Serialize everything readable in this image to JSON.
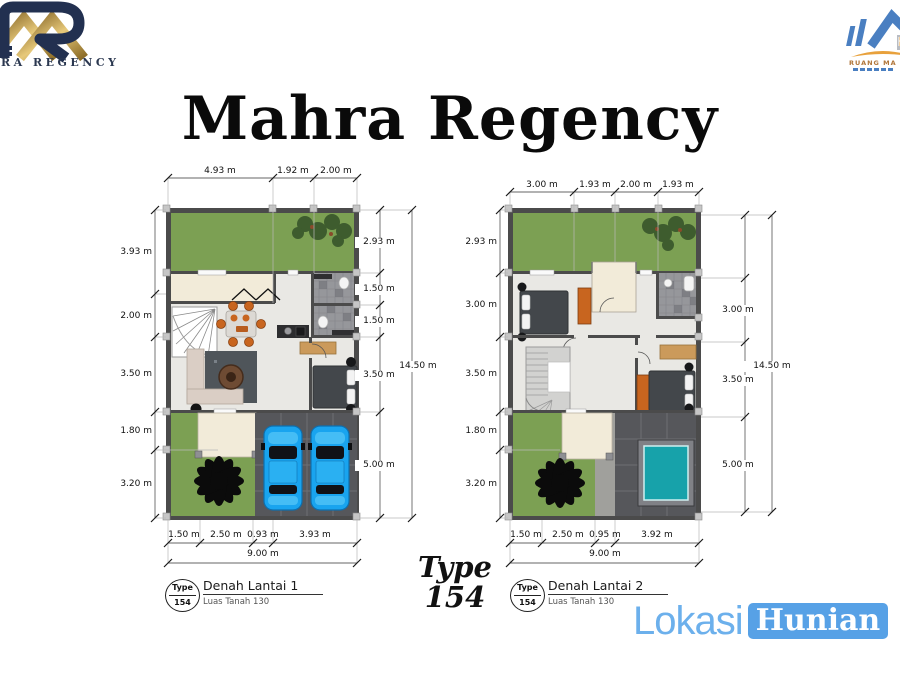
{
  "slide": {
    "title": "Mahra Regency"
  },
  "logo_left": {
    "brand_text": "RA REGENCY"
  },
  "logo_right": {
    "brand_text": "RUANG MA"
  },
  "plans": [
    {
      "plate": {
        "type_word": "Type",
        "type_number": "154",
        "title": "Denah Lantai 1",
        "subtitle": "Luas Tanah 130"
      },
      "dims_top": [
        "4.93 m",
        "1.92 m",
        "2.00 m"
      ],
      "dims_left": [
        "3.93 m",
        "2.00 m",
        "3.50 m",
        "1.80 m",
        "3.20 m"
      ],
      "dims_right": [
        "2.93 m",
        "1.50 m",
        "1.50 m",
        "3.50 m",
        "5.00 m"
      ],
      "total_right": "14.50 m",
      "dims_bottom": [
        "1.50 m",
        "2.50 m",
        "0.93 m",
        "3.93 m"
      ],
      "total_bottom": "9.00 m"
    },
    {
      "plate": {
        "type_word": "Type",
        "type_number": "154",
        "title": "Denah Lantai 2",
        "subtitle": "Luas Tanah 130"
      },
      "dims_top": [
        "3.00 m",
        "1.93 m",
        "2.00 m",
        "1.93 m"
      ],
      "dims_left": [
        "2.93 m",
        "3.00 m",
        "3.50 m",
        "1.80 m",
        "3.20 m"
      ],
      "dims_right": [
        "3.00 m",
        "3.50 m",
        "5.00 m"
      ],
      "total_right": "14.50 m",
      "dims_bottom": [
        "1.50 m",
        "2.50 m",
        "0.95 m",
        "3.92 m"
      ],
      "total_bottom": "9.00 m"
    }
  ],
  "center_label": {
    "line1": "Type",
    "line2": "154"
  },
  "watermark": {
    "text": "Lokasi",
    "text_boxed": "Hunian"
  },
  "colors": {
    "lawn": "#7ca053",
    "wall": "#4b4b4b",
    "floor": "#e9e8e4",
    "terrace": "#f2ebd9",
    "deck": "#56575b",
    "car_blue": "#19a4ef",
    "pool_teal": "#17a2aa",
    "furniture_orange": "#c8651f",
    "watermark_blue": "#57a1e6",
    "logo_navy": "#223050",
    "logo_gold": "#c9a24a"
  }
}
